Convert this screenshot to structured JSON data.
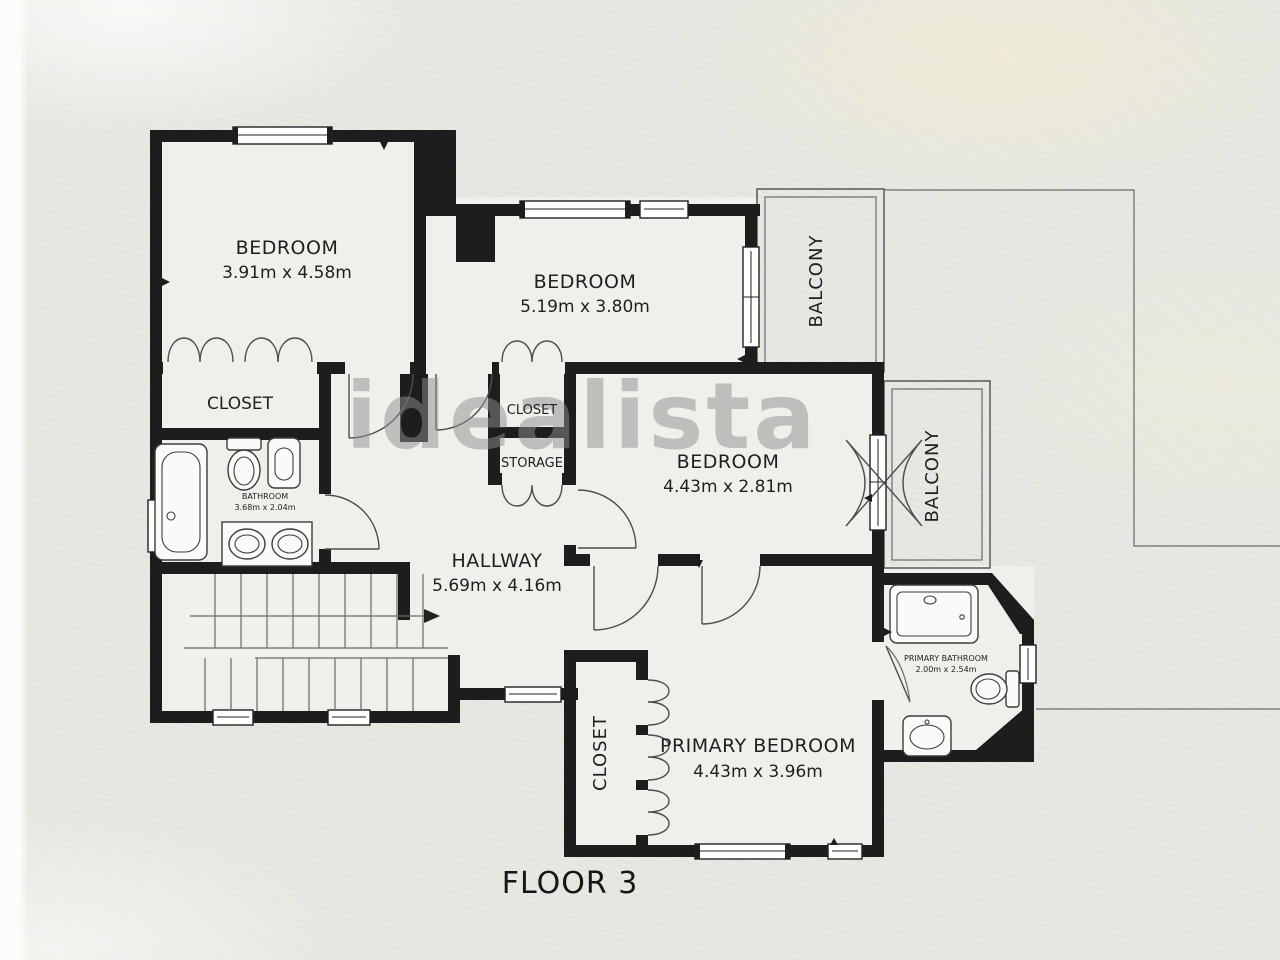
{
  "floor_plan": {
    "title": "FLOOR 3",
    "watermark": "idealista",
    "rooms": {
      "bedroom1": {
        "label": "BEDROOM",
        "dims": "3.91m x 4.58m"
      },
      "bedroom2": {
        "label": "BEDROOM",
        "dims": "5.19m x 3.80m"
      },
      "bedroom3": {
        "label": "BEDROOM",
        "dims": "4.43m x 2.81m"
      },
      "primary_bedroom": {
        "label": "PRIMARY BEDROOM",
        "dims": "4.43m x 3.96m"
      },
      "hallway": {
        "label": "HALLWAY",
        "dims": "5.69m x 4.16m"
      },
      "bathroom": {
        "label": "BATHROOM",
        "dims": "3.68m x 2.04m"
      },
      "primary_bathroom": {
        "label": "PRIMARY BATHROOM",
        "dims": "2.00m x 2.54m"
      },
      "closet_left": {
        "label": "CLOSET"
      },
      "closet_center": {
        "label": "CLOSET"
      },
      "storage": {
        "label": "STORAGE"
      },
      "closet_primary": {
        "label": "CLOSET"
      },
      "balcony_top": {
        "label": "BALCONY"
      },
      "balcony_right": {
        "label": "BALCONY"
      }
    },
    "colors": {
      "wall": "#1d1d1d",
      "floor": "#f0efec",
      "background": "#e8e8e6",
      "watermark_gray": "#8f8f8f"
    }
  }
}
